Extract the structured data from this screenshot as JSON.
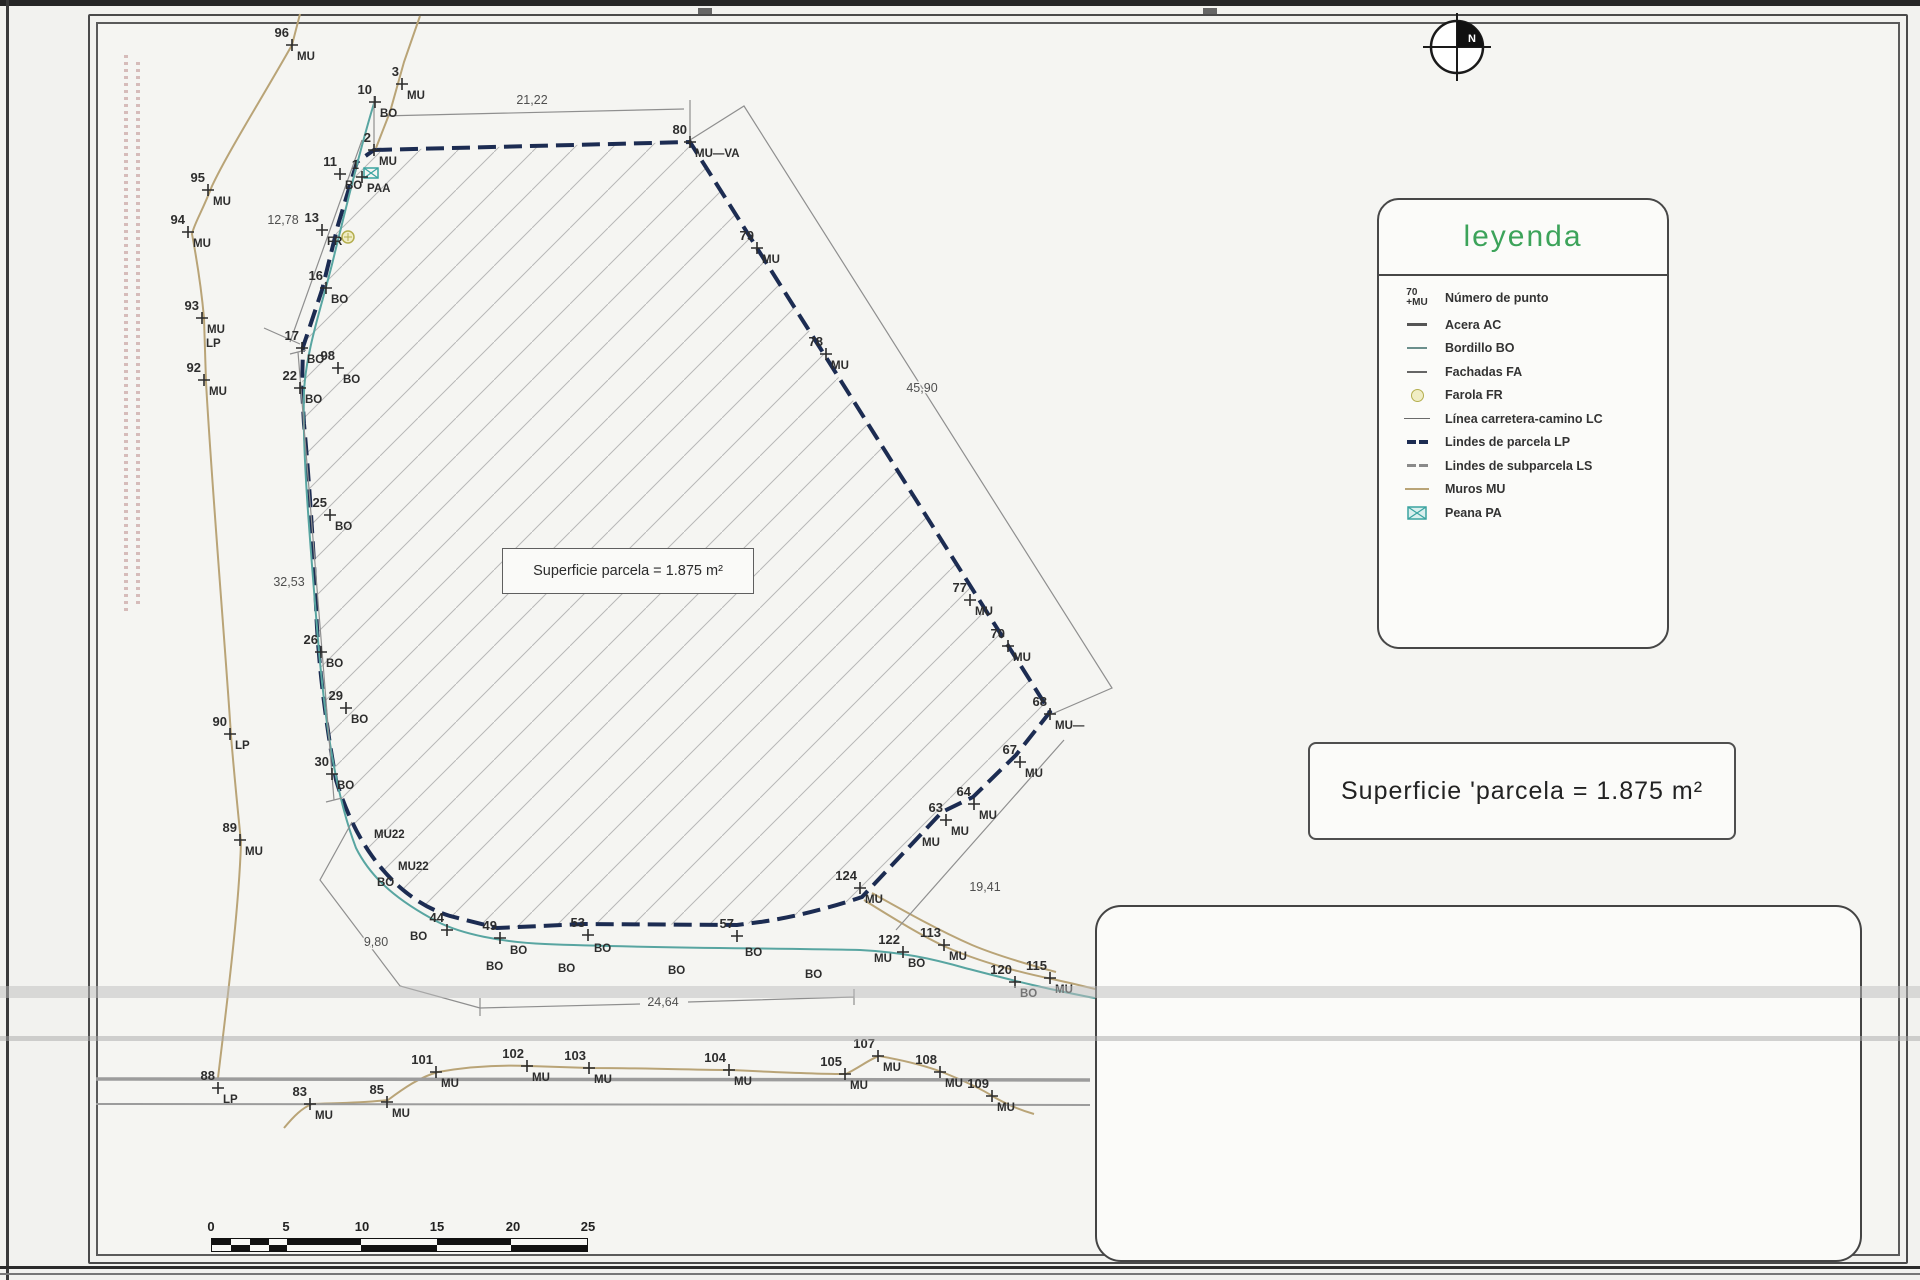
{
  "compass": {
    "label": "N"
  },
  "legend": {
    "title": "leyenda",
    "point_example": {
      "number": "70",
      "code": "MU",
      "label": "Número de punto"
    },
    "items": [
      {
        "label": "Acera",
        "code": "AC"
      },
      {
        "label": "Bordillo",
        "code": "BO"
      },
      {
        "label": "Fachadas",
        "code": "FA"
      },
      {
        "label": "Farola",
        "code": "FR"
      },
      {
        "label": "Línea carretera-camino",
        "code": "LC"
      },
      {
        "label": "Lindes de parcela",
        "code": "LP"
      },
      {
        "label": "Lindes de subparcela",
        "code": "LS"
      },
      {
        "label": "Muros",
        "code": "MU"
      },
      {
        "label": "Peana",
        "code": "PA"
      }
    ]
  },
  "area_labels": {
    "interior": "Superficie parcela = 1.875 m²",
    "box": "Superficie 'parcela  =  1.875  m²"
  },
  "dimensions": [
    {
      "text": "21,22",
      "x": 532,
      "y": 104
    },
    {
      "text": "12,78",
      "x": 283,
      "y": 224
    },
    {
      "text": "45,90",
      "x": 922,
      "y": 392
    },
    {
      "text": "32,53",
      "x": 289,
      "y": 586
    },
    {
      "text": "19,41",
      "x": 985,
      "y": 891
    },
    {
      "text": "9,80",
      "x": 376,
      "y": 946
    },
    {
      "text": "24,64",
      "x": 663,
      "y": 1006
    }
  ],
  "survey_points": [
    {
      "n": "96",
      "code": "MU",
      "x": 292,
      "y": 45
    },
    {
      "n": "3",
      "code": "MU",
      "x": 402,
      "y": 84
    },
    {
      "n": "10",
      "code": "BO",
      "x": 375,
      "y": 102
    },
    {
      "n": "2",
      "code": "MU",
      "x": 374,
      "y": 150
    },
    {
      "n": "11",
      "code": "BO",
      "x": 340,
      "y": 174
    },
    {
      "n": "1",
      "code": "PAA",
      "x": 362,
      "y": 177
    },
    {
      "n": "13",
      "code": "FR",
      "x": 322,
      "y": 230
    },
    {
      "n": "16",
      "code": "BO",
      "x": 326,
      "y": 288
    },
    {
      "n": "17",
      "code": "BO",
      "x": 302,
      "y": 348
    },
    {
      "n": "98",
      "code": "BO",
      "x": 338,
      "y": 368
    },
    {
      "n": "22",
      "code": "BO",
      "x": 300,
      "y": 388
    },
    {
      "n": "25",
      "code": "BO",
      "x": 330,
      "y": 515
    },
    {
      "n": "26",
      "code": "BO",
      "x": 321,
      "y": 652
    },
    {
      "n": "29",
      "code": "BO",
      "x": 346,
      "y": 708
    },
    {
      "n": "30",
      "code": "BO",
      "x": 332,
      "y": 774
    },
    {
      "n": "95",
      "code": "MU",
      "x": 208,
      "y": 190
    },
    {
      "n": "94",
      "code": "MU",
      "x": 188,
      "y": 232
    },
    {
      "n": "93",
      "code": "MU",
      "code2": "LP",
      "x": 202,
      "y": 318
    },
    {
      "n": "92",
      "code": "MU",
      "x": 204,
      "y": 380
    },
    {
      "n": "90",
      "code": "LP",
      "x": 230,
      "y": 734
    },
    {
      "n": "89",
      "code": "MU",
      "x": 240,
      "y": 840
    },
    {
      "n": "88",
      "code": "LP",
      "x": 218,
      "y": 1088
    },
    {
      "n": "83",
      "code": "MU",
      "x": 310,
      "y": 1104
    },
    {
      "n": "85",
      "code": "MU",
      "x": 387,
      "y": 1102
    },
    {
      "n": "44",
      "code": "",
      "x": 447,
      "y": 930
    },
    {
      "n": "49",
      "code": "",
      "x": 500,
      "y": 938
    },
    {
      "n": "53",
      "code": "",
      "x": 588,
      "y": 935
    },
    {
      "n": "57",
      "code": "",
      "x": 737,
      "y": 936
    },
    {
      "n": "101",
      "code": "MU",
      "x": 436,
      "y": 1072
    },
    {
      "n": "102",
      "code": "MU",
      "x": 527,
      "y": 1066
    },
    {
      "n": "103",
      "code": "MU",
      "x": 589,
      "y": 1068
    },
    {
      "n": "104",
      "code": "MU",
      "x": 729,
      "y": 1070
    },
    {
      "n": "105",
      "code": "MU",
      "x": 845,
      "y": 1074
    },
    {
      "n": "107",
      "code": "MU",
      "x": 878,
      "y": 1056
    },
    {
      "n": "108",
      "code": "MU",
      "x": 940,
      "y": 1072
    },
    {
      "n": "109",
      "code": "MU",
      "x": 992,
      "y": 1096
    },
    {
      "n": "124",
      "code": "MU",
      "x": 860,
      "y": 888
    },
    {
      "n": "113",
      "code": "MU",
      "x": 944,
      "y": 945
    },
    {
      "n": "122",
      "code": "BO",
      "x": 903,
      "y": 952
    },
    {
      "n": "120",
      "code": "BO",
      "x": 1015,
      "y": 982
    },
    {
      "n": "115",
      "code": "MU",
      "x": 1050,
      "y": 978
    },
    {
      "n": "80",
      "code": "MU—VA",
      "x": 690,
      "y": 142
    },
    {
      "n": "79",
      "code": "MU",
      "x": 757,
      "y": 248
    },
    {
      "n": "78",
      "code": "MU",
      "x": 826,
      "y": 354
    },
    {
      "n": "77",
      "code": "MU",
      "x": 970,
      "y": 600
    },
    {
      "n": "70",
      "code": "MU",
      "x": 1008,
      "y": 646
    },
    {
      "n": "68",
      "code": "MU—",
      "x": 1050,
      "y": 714
    },
    {
      "n": "67",
      "code": "MU",
      "x": 1020,
      "y": 762
    },
    {
      "n": "64",
      "code": "MU",
      "x": 974,
      "y": 804
    },
    {
      "n": "63",
      "code": "MU",
      "x": 946,
      "y": 820
    }
  ],
  "misc_labels": [
    {
      "text": "MU22",
      "x": 374,
      "y": 838
    },
    {
      "text": "MU22",
      "x": 398,
      "y": 870
    },
    {
      "text": "BO",
      "x": 377,
      "y": 886
    },
    {
      "text": "BO",
      "x": 410,
      "y": 940
    },
    {
      "text": "BO",
      "x": 510,
      "y": 954
    },
    {
      "text": "BO",
      "x": 594,
      "y": 952
    },
    {
      "text": "BO",
      "x": 745,
      "y": 956
    },
    {
      "text": "MU",
      "x": 874,
      "y": 962
    },
    {
      "text": "BO",
      "x": 486,
      "y": 970
    },
    {
      "text": "BO",
      "x": 558,
      "y": 972
    },
    {
      "text": "BO",
      "x": 668,
      "y": 974
    },
    {
      "text": "BO",
      "x": 805,
      "y": 978
    },
    {
      "text": "MU",
      "x": 922,
      "y": 846
    }
  ],
  "title_block": {
    "plano_label": "PLANO:",
    "plano_value": "Levantamiento  Topográfico",
    "solicitante_label": "SOLICITANTE:",
    "solicitante_value": "D.",
    "emplazamiento_label": "EMPLAZAMIENTO:",
    "emplazamiento_value": "PL  PP  CDS  ADELFAS  356.",
    "emplazamiento_line2": "T.M.  Benitachell  (Alicante)",
    "nplano_label": "n°  plano",
    "nplano_value": "1–1",
    "date_month": "FEBRERO",
    "date_year": "2.014",
    "ref_label": "referencia",
    "ref_value": "140203MA",
    "orient_label": "orientación",
    "escala_label": "escala",
    "escala_value": "1/300",
    "logo_text": "MEZQUIDA",
    "engineer": {
      "name": "D. Antonio Mezquida Salvá",
      "lines": [
        "Ingeniero Agrónomo n° col. 3.323",
        "Licenciado en Ciencias Ambientales n° col. 322",
        "Ingeniero Técnico Agrícola n° col. 561"
      ]
    }
  },
  "scale_bar": {
    "labels": [
      "0",
      "5",
      "10",
      "15",
      "20",
      "25"
    ]
  }
}
